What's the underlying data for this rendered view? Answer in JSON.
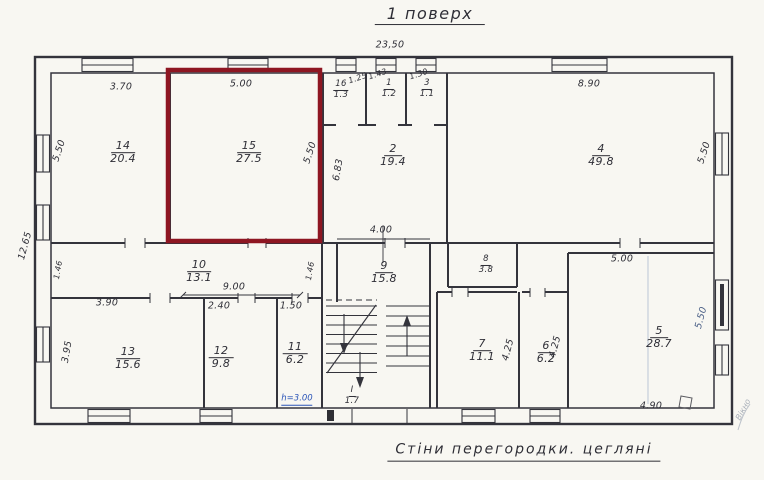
{
  "title": "1 поверх",
  "footer_note": "Стіни перегородки. цегляні",
  "highlight": {
    "room": "15",
    "color": "#8e1622"
  },
  "annotations": {
    "height_note": "h=3.00",
    "window_note": "Вікно"
  },
  "rooms": [
    {
      "n": "14",
      "a": "20.4"
    },
    {
      "n": "15",
      "a": "27.5"
    },
    {
      "n": "16",
      "a": "1.3"
    },
    {
      "n": "1",
      "a": "1.2"
    },
    {
      "n": "3",
      "a": "1.1"
    },
    {
      "n": "2",
      "a": "19.4"
    },
    {
      "n": "4",
      "a": "49.8"
    },
    {
      "n": "10",
      "a": "13.1"
    },
    {
      "n": "9",
      "a": "15.8"
    },
    {
      "n": "8",
      "a": "3.8"
    },
    {
      "n": "13",
      "a": "15.6"
    },
    {
      "n": "12",
      "a": "9.8"
    },
    {
      "n": "11",
      "a": "6.2"
    },
    {
      "n": "I",
      "a": "1.7"
    },
    {
      "n": "7",
      "a": "11.1"
    },
    {
      "n": "6",
      "a": "6.2"
    },
    {
      "n": "5",
      "a": "28.7"
    }
  ],
  "dims": {
    "overall_width": "23,50",
    "overall_height": "12.65",
    "d370": "3.70",
    "d500a": "5.00",
    "d125": "1.25",
    "d143": "1.43",
    "d130": "1.30",
    "d890": "8.90",
    "d550a": "5.50",
    "d550b": "5.50",
    "d683": "6.83",
    "d550c": "5.50",
    "d146a": "1.46",
    "d146b": "1.46",
    "d400": "4.00",
    "d900": "9.00",
    "d240": "2.40",
    "d150": "1.50",
    "d390": "3.90",
    "d395": "3.95",
    "d500b": "5.00",
    "d550d": "5.50",
    "d425a": "4.25",
    "d425b": "4.25",
    "d490": "4.90"
  }
}
